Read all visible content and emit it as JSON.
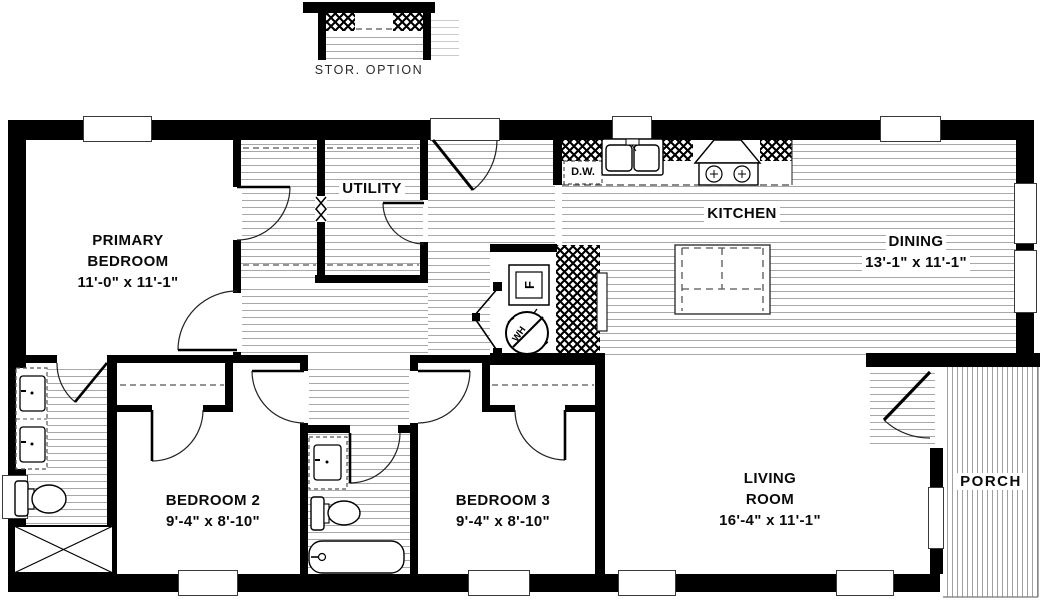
{
  "detail": {
    "storage_label": "STOR. OPTION"
  },
  "rooms": {
    "primary_bedroom": {
      "line1": "PRIMARY",
      "line2": "BEDROOM",
      "dims": "11'-0\" x  11'-1\""
    },
    "utility": {
      "name": "UTILITY"
    },
    "kitchen": {
      "name": "KITCHEN"
    },
    "dining": {
      "name": "DINING",
      "dims": "13'-1\" x  11'-1\""
    },
    "bedroom2": {
      "name": "BEDROOM 2",
      "dims": "9'-4\" x  8'-10\""
    },
    "bedroom3": {
      "name": "BEDROOM 3",
      "dims": "9'-4\" x  8'-10\""
    },
    "living_room": {
      "line1": "LIVING",
      "line2": "ROOM",
      "dims": "16'-4\" x  11'-1\""
    },
    "porch": {
      "name": "PORCH"
    }
  },
  "appliances": {
    "dishwasher": "D.W.",
    "furnace": "F",
    "water_heater": "WH"
  },
  "colors": {
    "wall": "#000000",
    "floor_line": "#a8a8a8",
    "background": "#ffffff"
  }
}
